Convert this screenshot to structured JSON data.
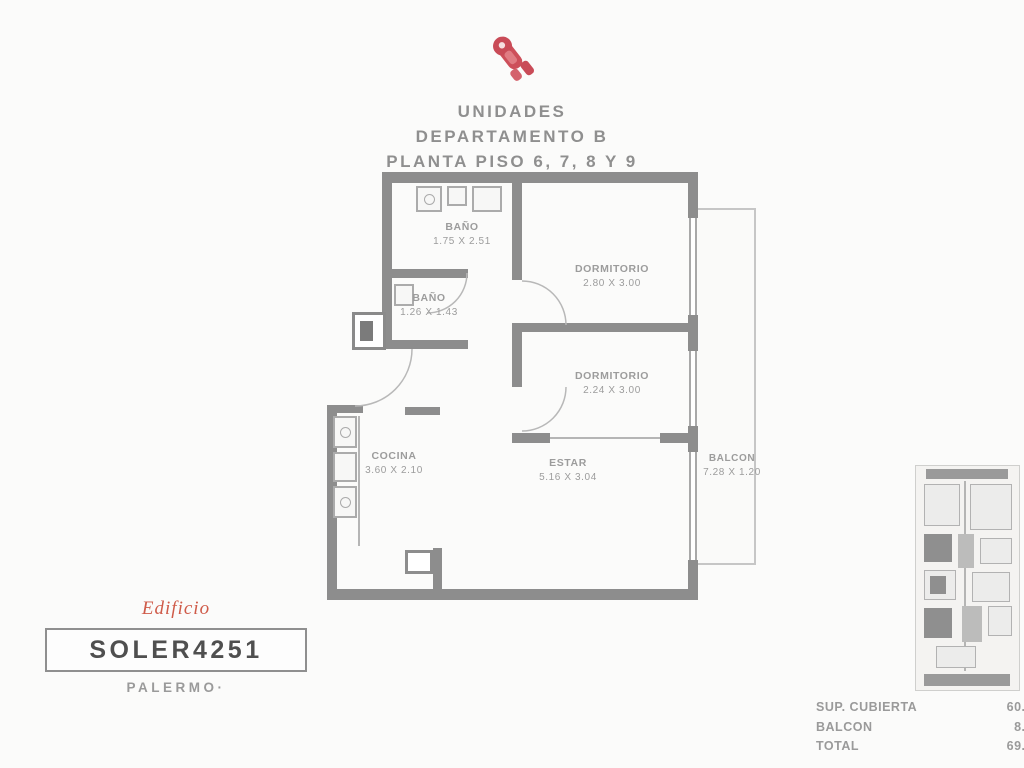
{
  "header": {
    "title_line1": "UNIDADES",
    "title_line2": "DEPARTAMENTO B",
    "title_line3": "PLANTA PISO 6, 7, 8 Y 9"
  },
  "floorplan": {
    "rooms": [
      {
        "name": "BAÑO",
        "dims": "1.75 X 2.51"
      },
      {
        "name": "BAÑO",
        "dims": "1.26 X 1.43"
      },
      {
        "name": "DORMITORIO",
        "dims": "2.80 X 3.00"
      },
      {
        "name": "DORMITORIO",
        "dims": "2.24 X 3.00"
      },
      {
        "name": "COCINA",
        "dims": "3.60 X 2.10"
      },
      {
        "name": "ESTAR",
        "dims": "5.16 X 3.04"
      },
      {
        "name": "BALCON",
        "dims": "7.28 X 1.20"
      }
    ]
  },
  "branding": {
    "edificio_label": "Edificio",
    "building_name": "SOLER4251",
    "neighborhood": "PALERMO·"
  },
  "areas": [
    {
      "label": "SUP. CUBIERTA",
      "value": "60.67M²"
    },
    {
      "label": "BALCON",
      "value": "8.69M²"
    },
    {
      "label": "TOTAL",
      "value": "69.36M²"
    }
  ],
  "colors": {
    "logo_red": "#cd4f5a",
    "accent_red": "#cf5b49",
    "wall_gray": "#8d8d8d",
    "label_gray": "#9c9c9c"
  }
}
